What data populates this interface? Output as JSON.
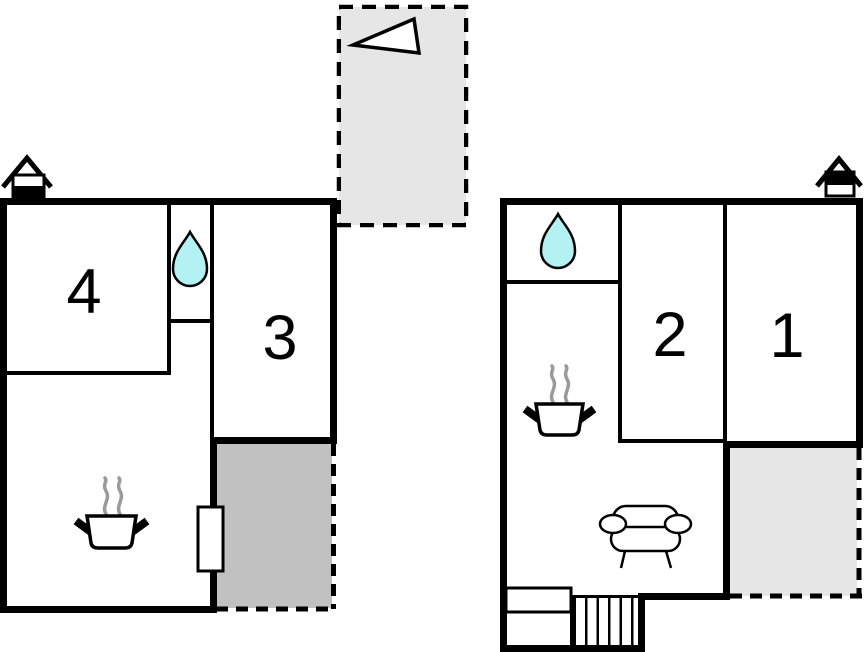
{
  "page": {
    "background": "#ffffff",
    "description": "Two-storey holiday house floor plan with numbered rooms"
  },
  "colors": {
    "wall": "#000000",
    "terrace_dark": "#c1c1c1",
    "terrace_light": "#e6e6e6",
    "annex_fill": "#e6e6e6",
    "water_drop": "#b3f1f2",
    "steam": "#9a9a9a",
    "icon_fill": "#ffffff"
  },
  "plans": {
    "left": {
      "rooms": [
        {
          "label": "4"
        },
        {
          "label": "3"
        }
      ]
    },
    "right": {
      "rooms": [
        {
          "label": "2"
        },
        {
          "label": "1"
        }
      ]
    }
  },
  "icons": {
    "north_arrow": "north-arrow-triangle",
    "chimney": "fireplace-chimney",
    "water_drop": "bathroom-water-drop",
    "pot": "kitchen-cooking-pot",
    "sofa": "living-room-sofa",
    "stairs": "staircase",
    "door": "terrace-door",
    "window": "window"
  }
}
